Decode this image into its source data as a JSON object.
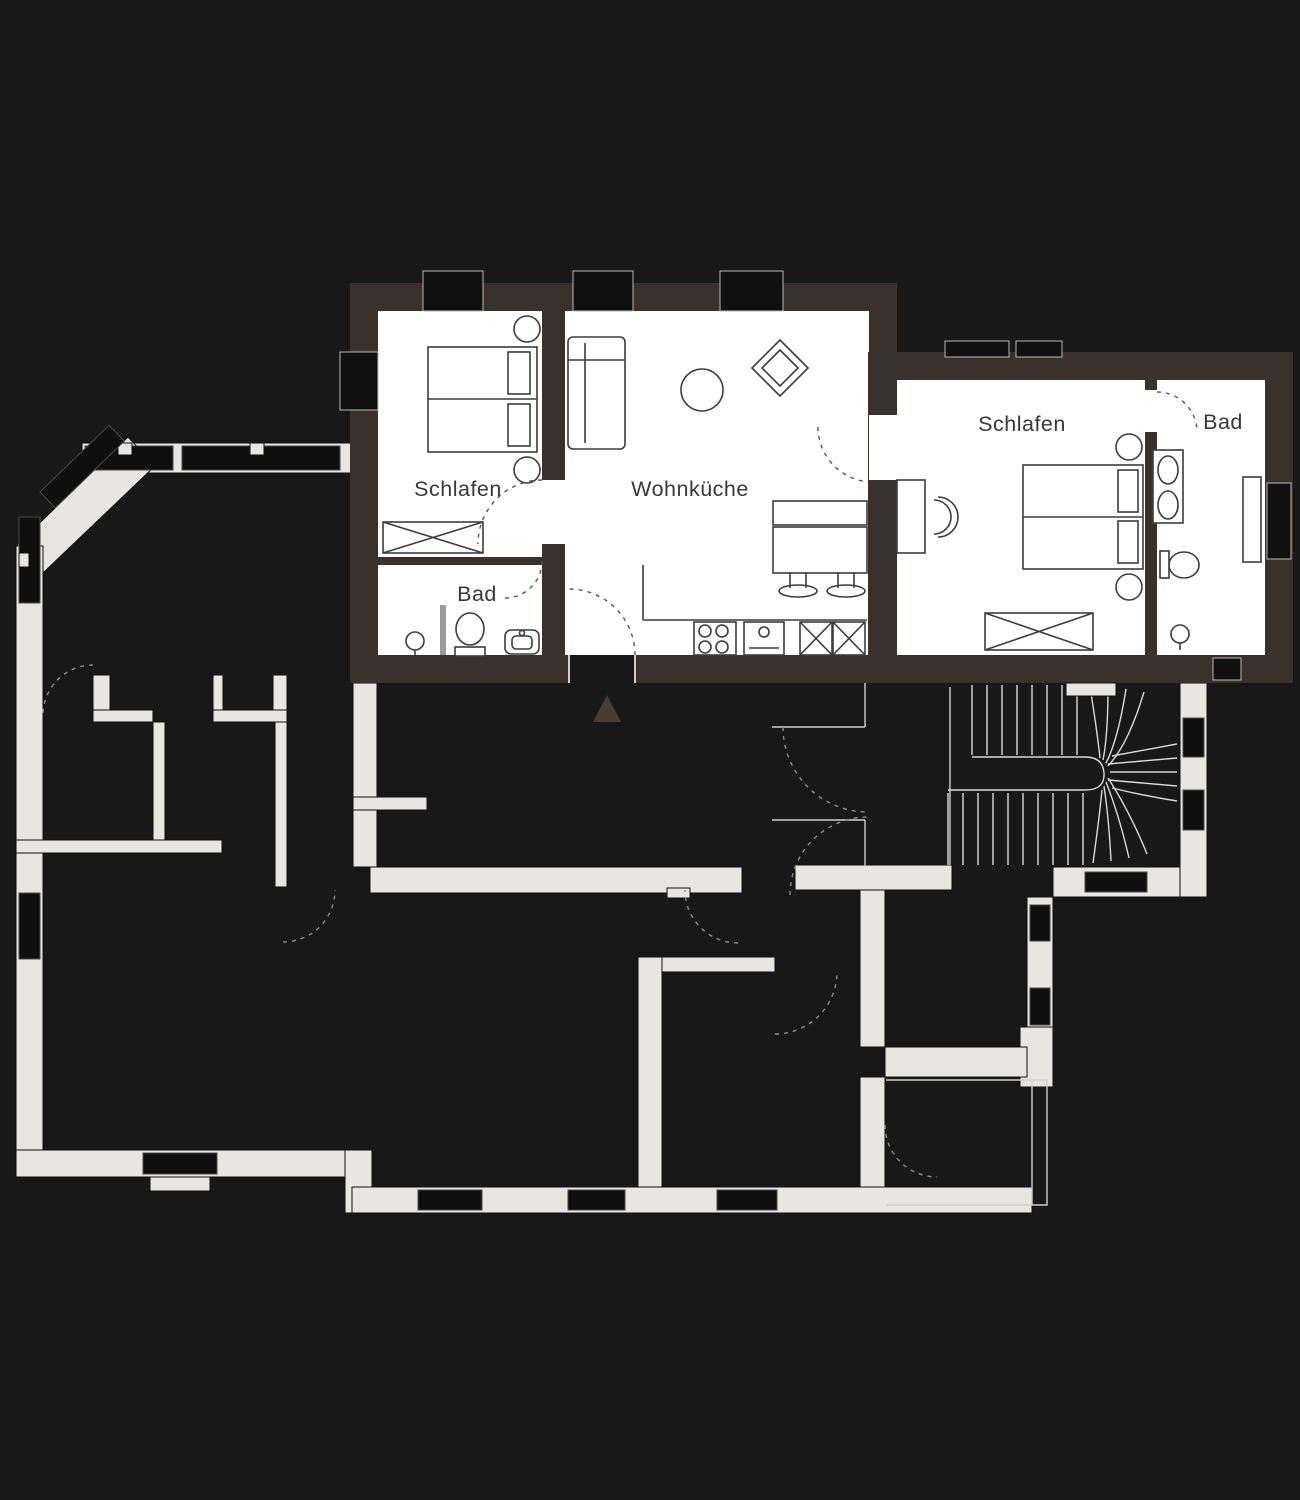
{
  "plan_title": "floor-plan",
  "apartment_top": {
    "bedroom_label": "Schlafen",
    "living_kitchen_label": "Wohnküche",
    "bath_label": "Bad"
  },
  "apartment_right": {
    "bedroom_label": "Schlafen",
    "bath_label": "Bad"
  },
  "marker": {
    "icon": "entrance-triangle-icon"
  },
  "colors": {
    "background": "#181818",
    "highlighted_room": "#ffffff",
    "wall_dark": "#39322c",
    "wall_light": "#e8e6e3",
    "furniture_line": "#3c3c3c",
    "label_text": "#383838",
    "stair_line": "#d9d9d9",
    "window_dark": "#0f0f0f"
  }
}
